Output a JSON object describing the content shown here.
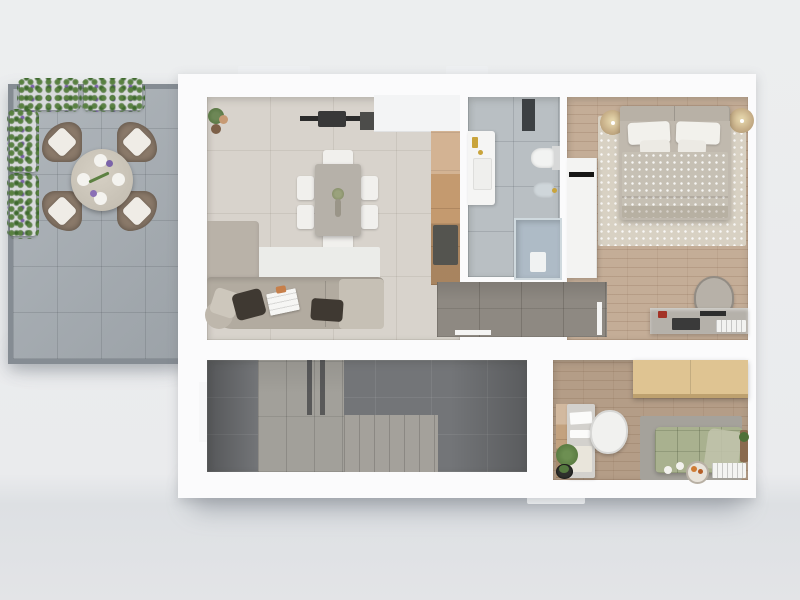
{
  "scene": {
    "description": "Top-down 3D rendered floor plan of an apartment with outdoor terrace",
    "canvas": {
      "width": 800,
      "height": 600
    }
  },
  "palette": {
    "background_top": "#eceeef",
    "background_bottom": "#dde0e3",
    "plate_white": "#fbfbfc",
    "window_tab": "#eef0f2",
    "terrace_floor": "#a7aeb4",
    "terrace_rim": "#858c93",
    "foliage_green": "#4e7839",
    "lavender_purple": "#7b63a9",
    "rattan_brown": "#8b7a6a",
    "cushion_cream": "#efece6",
    "terrace_table": "#cbc5b9",
    "living_floor": "#d8d3cc",
    "dining_table": "#b6b1a9",
    "chair_white": "#f1f0ed",
    "tv_black": "#2b2b2b",
    "kitchen_wood": "#c49a6f",
    "hob_dark": "#54544f",
    "sofa_taupe": "#b2aba0",
    "sofa_back": "#b9b2a8",
    "pillow_dark": "#3f3932",
    "rug_living": "#ebece9",
    "bathroom_floor": "#b9bfc3",
    "shower_glass": "#aebbc6",
    "fixture_gold": "#c9a43c",
    "bedroom_floor": "#c4ad97",
    "bed_duvet": "#c6c0b4",
    "pillow_white": "#f2f1ec",
    "headboard": "#b8b1a6",
    "rug_bedroom": "#d8d1c3",
    "desk_gray": "#b5b1aa",
    "corridor_floor": "#8e8982",
    "utility_floor_dark": "#737578",
    "utility_floor_light": "#a2a09a",
    "office_floor": "#b49d87",
    "office_wardrobe_tan": "#dfc492",
    "office_desk": "#d3d1cd",
    "office_sofa_green": "#a9b18f",
    "office_rug": "#a5a29b"
  },
  "terrace": {
    "items": [
      "lavender-planters",
      "round-dining-table",
      "four-rattan-armchairs",
      "concrete-tile-floor"
    ]
  },
  "rooms": {
    "living_dining": {
      "items": [
        "wall-tv-panel",
        "kitchen-cabinets",
        "kitchen-wood-counter",
        "induction-hob",
        "dining-table-six-chairs",
        "corner-sofa",
        "white-rug",
        "floor-plant"
      ]
    },
    "bathroom": {
      "items": [
        "vanity-sink",
        "wall-hung-toilet",
        "bidet",
        "walk-in-shower",
        "wall-shelf"
      ]
    },
    "bedroom": {
      "items": [
        "double-bed",
        "bedside-lamp-left",
        "bedside-lamp-right",
        "wardrobe",
        "dotted-rug",
        "desk",
        "desk-chair"
      ]
    },
    "hallway": {
      "items": [
        "door-leaf",
        "gray-tile-floor"
      ]
    },
    "utility": {
      "items": [
        "staircase-treads",
        "pillars",
        "tile-floor"
      ]
    },
    "office": {
      "items": [
        "tan-wardrobe",
        "white-desk",
        "white-chair",
        "green-daybed-sofa",
        "gray-rug",
        "potted-plants",
        "serving-tray",
        "stacked-books",
        "side-table"
      ]
    }
  }
}
